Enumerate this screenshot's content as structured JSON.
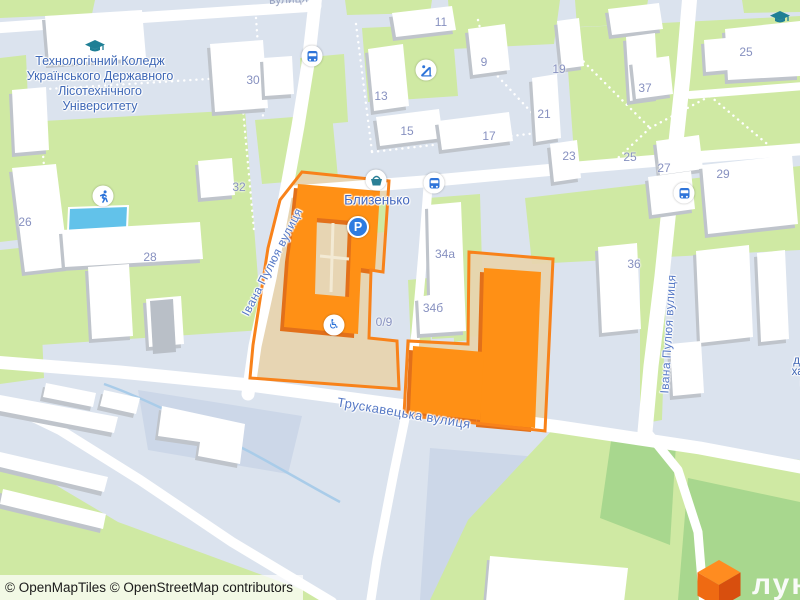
{
  "map": {
    "attribution": "© OpenMapTiles © OpenStreetMap contributors",
    "logo": {
      "text": "лун"
    },
    "poi_labels": {
      "college_lines": [
        "Технологічний Коледж",
        "Українського Державного",
        "Лісотехнічного",
        "Університету"
      ],
      "complex_name": "Близенько",
      "edge_partial_lines": [
        "Ль",
        "держа",
        "харчов",
        "про"
      ],
      "top_partial": "вулиця"
    },
    "street_labels": {
      "ivana_pulyuya_left": "Івана Пулюя вулиця",
      "ivana_pulyuya_right": "Івана Пулюя вулиця",
      "truskavetska": "Трускавецька вулиця"
    },
    "house_numbers": [
      {
        "text": "30",
        "x": 253,
        "y": 80
      },
      {
        "text": "32",
        "x": 239,
        "y": 187
      },
      {
        "text": "26",
        "x": 25,
        "y": 222
      },
      {
        "text": "28",
        "x": 150,
        "y": 257
      },
      {
        "text": "11",
        "x": 441,
        "y": 22
      },
      {
        "text": "9",
        "x": 484,
        "y": 62
      },
      {
        "text": "13",
        "x": 381,
        "y": 96
      },
      {
        "text": "15",
        "x": 407,
        "y": 131
      },
      {
        "text": "17",
        "x": 489,
        "y": 136
      },
      {
        "text": "19",
        "x": 559,
        "y": 69
      },
      {
        "text": "21",
        "x": 544,
        "y": 114
      },
      {
        "text": "23",
        "x": 569,
        "y": 156
      },
      {
        "text": "25",
        "x": 746,
        "y": 52
      },
      {
        "text": "25",
        "x": 630,
        "y": 157
      },
      {
        "text": "27",
        "x": 664,
        "y": 168
      },
      {
        "text": "29",
        "x": 723,
        "y": 174
      },
      {
        "text": "37",
        "x": 645,
        "y": 88
      },
      {
        "text": "36",
        "x": 634,
        "y": 264
      },
      {
        "text": "34а",
        "x": 445,
        "y": 254
      },
      {
        "text": "34б",
        "x": 433,
        "y": 308
      },
      {
        "text": "0/9",
        "x": 384,
        "y": 322
      }
    ],
    "icons": [
      {
        "name": "graduation-cap-icon",
        "x": 95,
        "y": 47
      },
      {
        "name": "graduation-cap-icon",
        "x": 780,
        "y": 18
      },
      {
        "name": "bus-stop-icon",
        "x": 312,
        "y": 56
      },
      {
        "name": "bus-stop-icon",
        "x": 434,
        "y": 183
      },
      {
        "name": "bus-stop-icon",
        "x": 684,
        "y": 193
      },
      {
        "name": "shop-icon",
        "x": 376,
        "y": 180
      },
      {
        "name": "parking-icon",
        "x": 358,
        "y": 227
      },
      {
        "name": "wheelchair-icon",
        "x": 334,
        "y": 325
      },
      {
        "name": "running-person-icon",
        "x": 103,
        "y": 196
      },
      {
        "name": "playground-icon",
        "x": 426,
        "y": 70
      }
    ],
    "colors": {
      "background": "#dbe3ee",
      "green": "#cfe9a3",
      "dark_green": "#a8d78e",
      "industrial": "#ccd7e8",
      "building_side": "#bfc4cb",
      "road": "#ffffff",
      "water": "#62c2ea",
      "stream": "#a9cce9",
      "highlight_orange": "#ff9015",
      "highlight_side": "#e2701a",
      "outline_orange": "#f8821a",
      "courtyard_tan": "#e7d4ae",
      "courtyard_path": "#f3ead4",
      "label_blue": "#3f68b6",
      "street_blue": "#5578c5",
      "number_blue": "#8791c0",
      "icon_blue": "#2e74d9",
      "education_teal": "#1f7f95",
      "logo_orange": "#ef6a12"
    }
  }
}
